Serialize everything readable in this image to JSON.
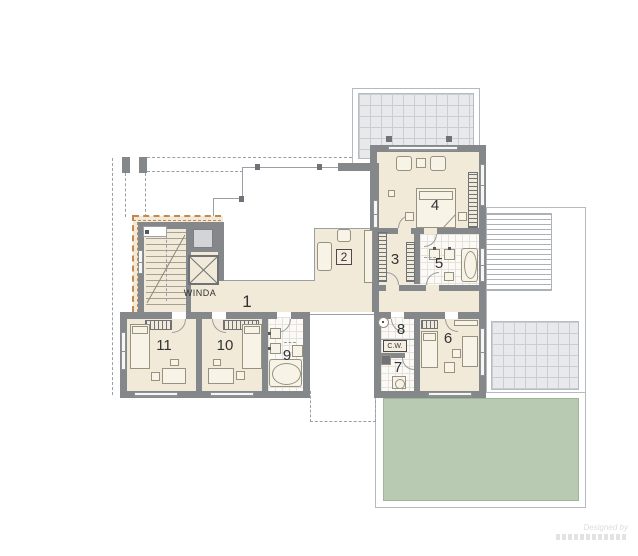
{
  "labels": {
    "elevator": "WINDA",
    "hot_water": "C.W.",
    "rooms": {
      "r1": "1",
      "r2": "2",
      "r3": "3",
      "r4": "4",
      "r5": "5",
      "r6": "6",
      "r7": "7",
      "r8": "8",
      "r9": "9",
      "r10": "10",
      "r11": "11"
    }
  },
  "watermark": {
    "line1": "Designed by"
  },
  "colors": {
    "wall": "#85888b",
    "floor": "#f2ead9",
    "terrace": "#e7e9eb",
    "green_roof": "#b9cab3",
    "insulation_accent": "#c4874e"
  }
}
